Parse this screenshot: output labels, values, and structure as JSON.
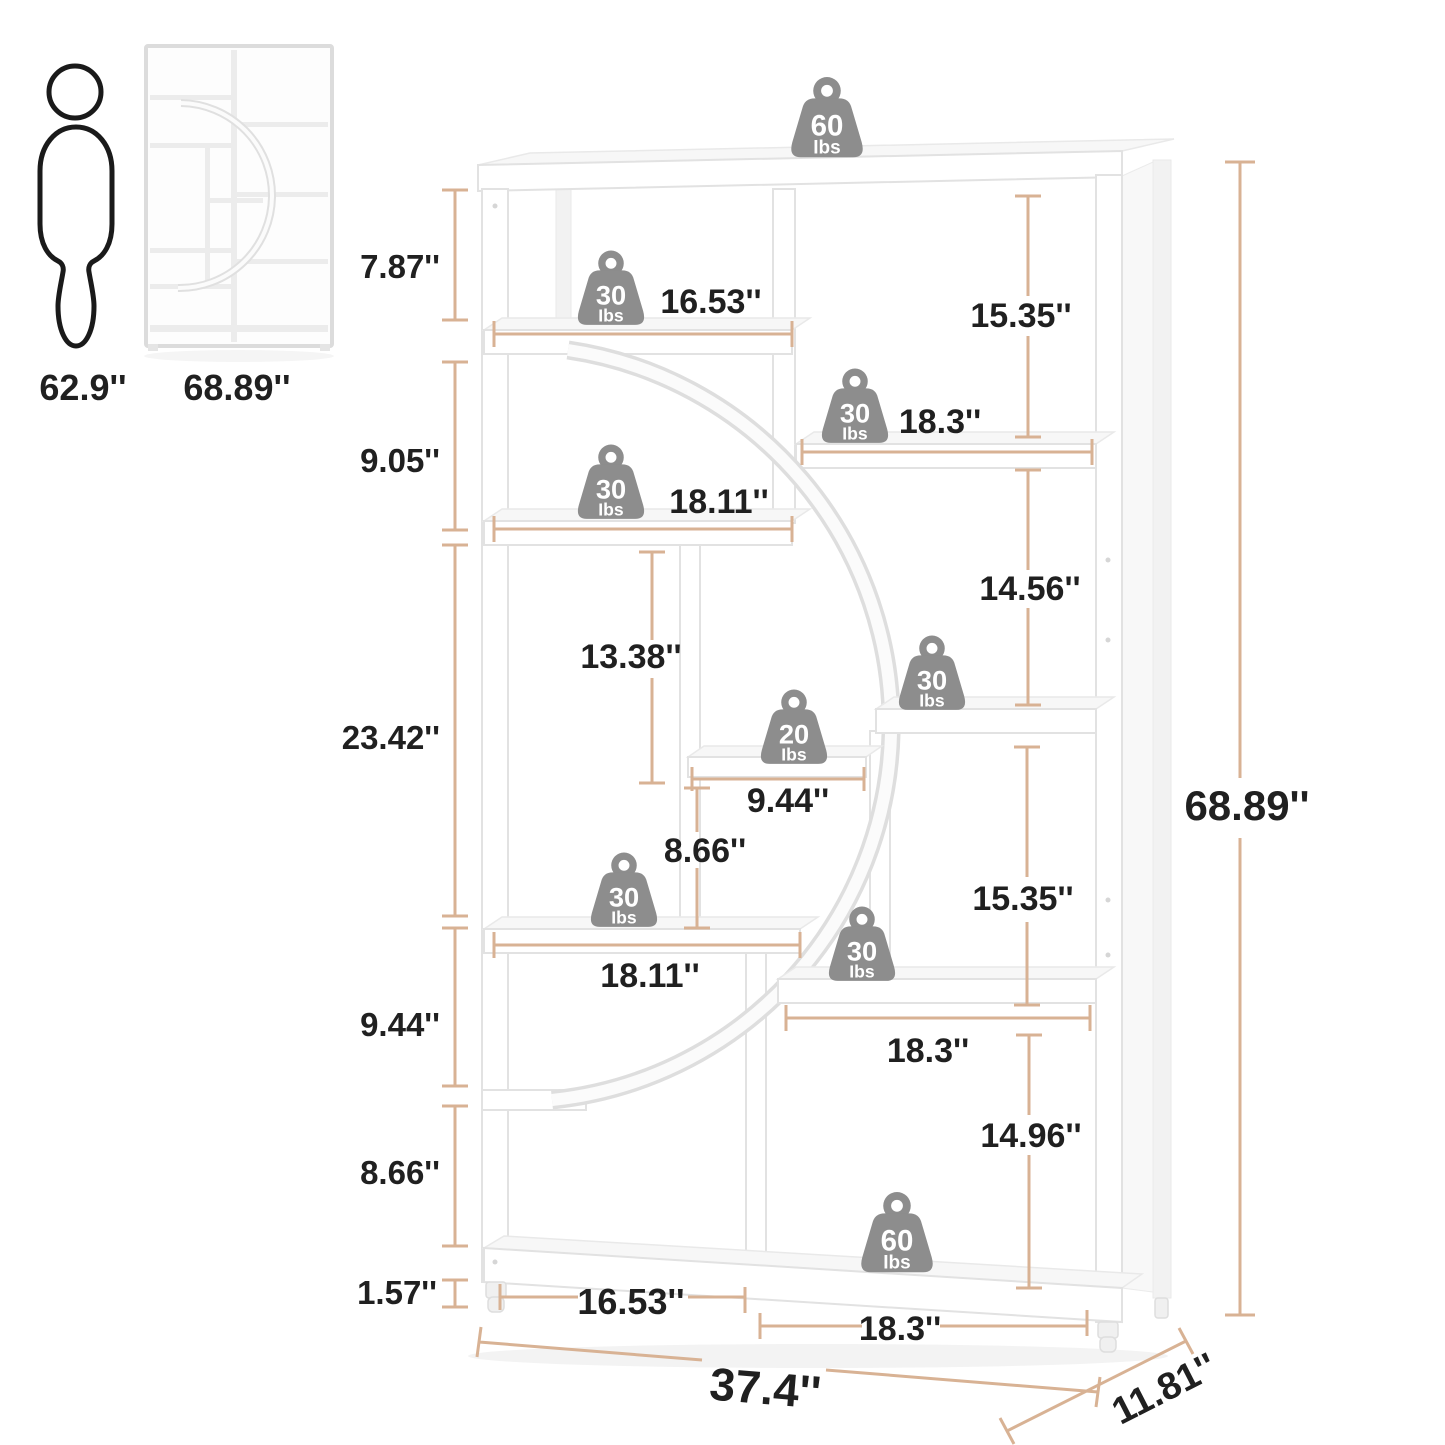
{
  "title": "Bookshelf dimensions diagram",
  "reference": {
    "person_height": "62.9''",
    "unit_height": "68.89''"
  },
  "weights": {
    "unit": "Ibs",
    "items": [
      {
        "value": "60"
      },
      {
        "value": "30"
      },
      {
        "value": "30"
      },
      {
        "value": "30"
      },
      {
        "value": "20"
      },
      {
        "value": "30"
      },
      {
        "value": "30"
      },
      {
        "value": "30"
      },
      {
        "value": "60"
      }
    ]
  },
  "dims": {
    "left": [
      "7.87''",
      "9.05''",
      "23.42''",
      "9.44''",
      "8.66''",
      "1.57''"
    ],
    "top_shelf_width": "16.53''",
    "upper_shelf_width": "18.11''",
    "lower_shelf_width": "18.11''",
    "right_upper_shelf_width": "18.3''",
    "right_lower_shelf_width": "18.3''",
    "small_shelf_width": "9.44''",
    "column_gap_height": "13.38''",
    "middle_gap_height": "8.66''",
    "right_gaps": [
      "15.35''",
      "14.56''",
      "15.35''",
      "14.96''"
    ],
    "bottom_left_width": "16.53''",
    "bottom_right_width": "18.3''",
    "overall_width": "37.4''",
    "overall_depth": "11.81''",
    "overall_height": "68.89''"
  },
  "colors": {
    "dimension_line": "#d8b294",
    "label_text": "#202020",
    "weight_badge": "#8d8d8d"
  }
}
